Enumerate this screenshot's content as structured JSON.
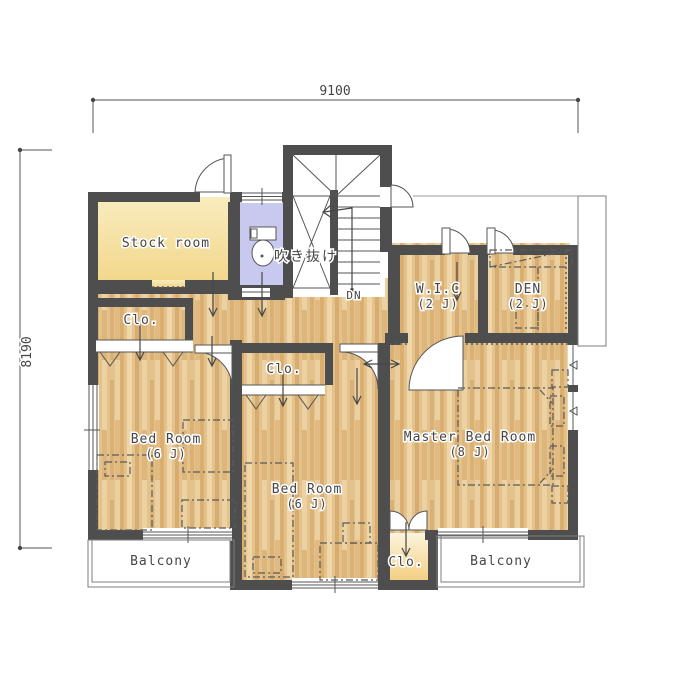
{
  "plan": {
    "dimensions": {
      "top": "9100",
      "left": "8190"
    },
    "rooms": {
      "stock_room": "Stock room",
      "atrium": "吹き抜け",
      "stairs_direction": "DN",
      "wic": "W.I.C",
      "wic_size": "(2 J)",
      "den": "DEN",
      "den_size": "(2 J)",
      "closet_left": "Clo.",
      "closet_middle": "Clo.",
      "closet_bottom": "Clo.",
      "bedroom_left": "Bed Room",
      "bedroom_left_size": "(6 J)",
      "bedroom_middle": "Bed Room",
      "bedroom_middle_size": "(6 J)",
      "master_bedroom": "Master Bed Room",
      "master_bedroom_size": "(8 J)",
      "balcony_left": "Balcony",
      "balcony_right": "Balcony"
    },
    "colors": {
      "wall": "#4e4e4e",
      "wood_floor": "#e3c28c",
      "stock_room_fill": "#f5df9e",
      "toilet_fill": "#c9c9f0",
      "closet_bottom_fill": "#f4d287",
      "line": "#555555"
    }
  }
}
